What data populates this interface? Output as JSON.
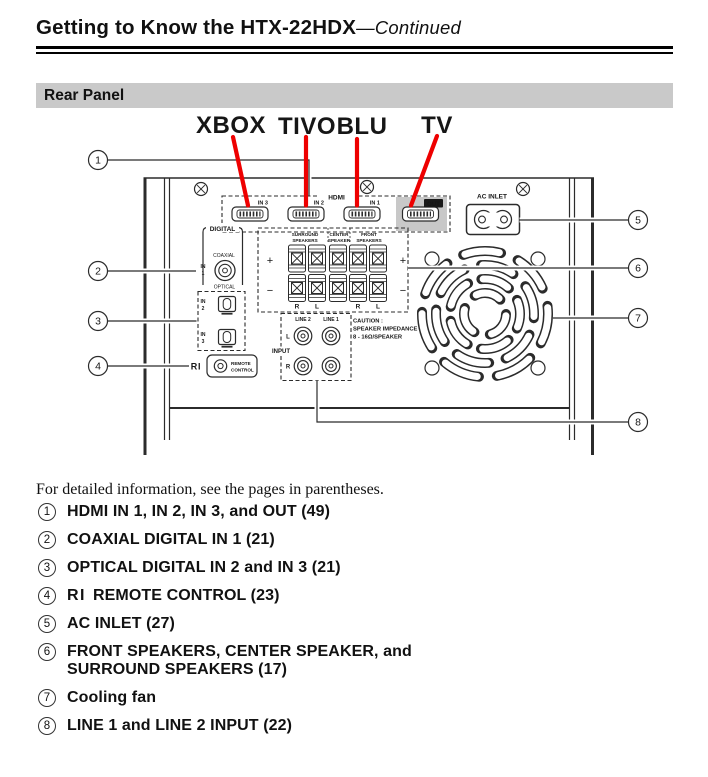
{
  "header": {
    "title": "Getting to Know the HTX-22HDX",
    "title_suffix": "—Continued",
    "section": "Rear Panel"
  },
  "colors": {
    "accent_red": "#ee0000",
    "panel_gray": "#c8c8c8"
  },
  "annotations": {
    "xbox": "XBOX",
    "tivo": "TIVO",
    "blu": "BLU",
    "tv": "TV"
  },
  "panel": {
    "hdmi": {
      "group_label": "HDMI",
      "in3": "IN 3",
      "in2": "IN 2",
      "in1": "IN 1",
      "out": "OUT"
    },
    "digital": {
      "group_label": "DIGITAL",
      "coaxial_label": "COAXIAL",
      "in_word": "IN",
      "num1": "1",
      "optical_label": "OPTICAL",
      "num2": "2",
      "num3": "3"
    },
    "remote": {
      "ri_logo": "RI",
      "line1": "REMOTE",
      "line2": "CONTROL"
    },
    "speakers": {
      "surround_l1": "SURROUND",
      "surround_l2": "SPEAKERS",
      "center_l1": "CENTER",
      "center_l2": "SPEAKER",
      "front_l1": "FRONT",
      "front_l2": "SPEAKERS",
      "plus": "+",
      "minus": "−",
      "r": "R",
      "l": "L"
    },
    "line_input": {
      "line2": "LINE 2",
      "line1": "LINE 1",
      "l": "L",
      "r": "R",
      "input": "INPUT"
    },
    "caution": {
      "l1": "CAUTION :",
      "l2": "SPEAKER IMPEDANCE",
      "l3": "8 - 16Ω/SPEAKER"
    },
    "ac_inlet": {
      "label": "AC INLET"
    },
    "callouts": {
      "c1": "1",
      "c2": "2",
      "c3": "3",
      "c4": "4",
      "c5": "5",
      "c6": "6",
      "c7": "7",
      "c8": "8"
    }
  },
  "legend": {
    "intro": "For detailed information, see the pages in parentheses.",
    "items": [
      {
        "num": "1",
        "text": "HDMI IN 1, IN 2, IN 3, and OUT (49)"
      },
      {
        "num": "2",
        "text": "COAXIAL DIGITAL IN 1 (21)"
      },
      {
        "num": "3",
        "text": "OPTICAL DIGITAL IN 2 and IN 3 (21)"
      },
      {
        "num": "4",
        "logo": "RI",
        "text": "REMOTE CONTROL (23)"
      },
      {
        "num": "5",
        "text": "AC INLET (27)"
      },
      {
        "num": "6",
        "text": "FRONT SPEAKERS, CENTER SPEAKER, and SURROUND SPEAKERS (17)"
      },
      {
        "num": "7",
        "text": "Cooling fan"
      },
      {
        "num": "8",
        "text": "LINE 1 and LINE 2 INPUT (22)"
      }
    ]
  }
}
